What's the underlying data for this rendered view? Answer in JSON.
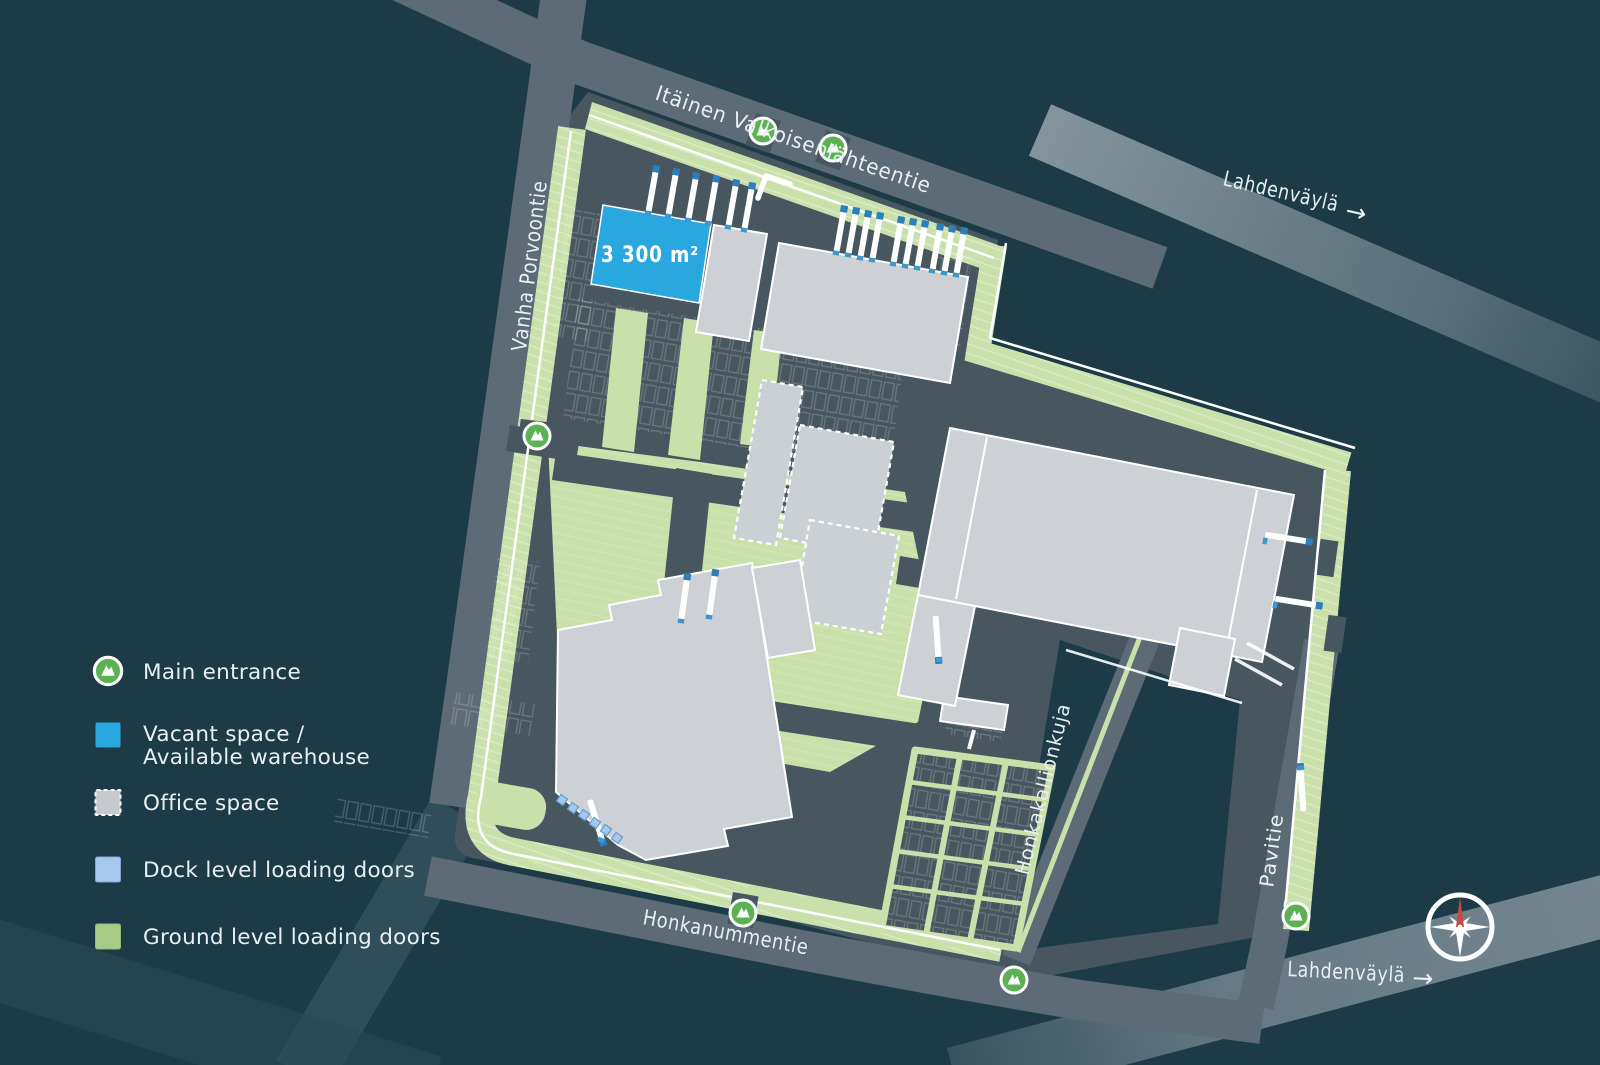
{
  "map": {
    "vacant_area_label": "3 300 m²",
    "streets": {
      "itainen": "Itäinen Valkoisenlähteentie",
      "vanha_porvoontie": "Vanha Porvoontie",
      "lahdenvayla_top": "Lahdenväylä",
      "lahdenvayla_bottom": "Lahdenväylä",
      "honkanummentie": "Honkanummentie",
      "honkakallionkuja": "Honkakallionkuja",
      "pavitie": "Pavitie",
      "direction_arrow": "→"
    }
  },
  "legend": {
    "items": [
      {
        "id": "main-entrance",
        "label": "Main entrance"
      },
      {
        "id": "vacant-space",
        "label": "Vacant space /",
        "label2": "Available warehouse"
      },
      {
        "id": "office-space",
        "label": "Office space"
      },
      {
        "id": "dock-level-doors",
        "label": "Dock level loading doors"
      },
      {
        "id": "ground-level-doors",
        "label": "Ground level loading doors"
      }
    ]
  },
  "colors": {
    "background": "#1c3b47",
    "site_ground": "#47565f",
    "road": "#5c6b75",
    "highway": "#8a98a1",
    "landscaping_green": "#c9e0aa",
    "building_gray": "#cdd1d5",
    "vacant_blue": "#29a8e0",
    "dock_door_blue": "#a6c8ec",
    "ground_door_green": "#a8cc86",
    "entrance_green": "#5cb253",
    "compass_red": "#c64a3f",
    "label_text": "#e9eff1"
  }
}
